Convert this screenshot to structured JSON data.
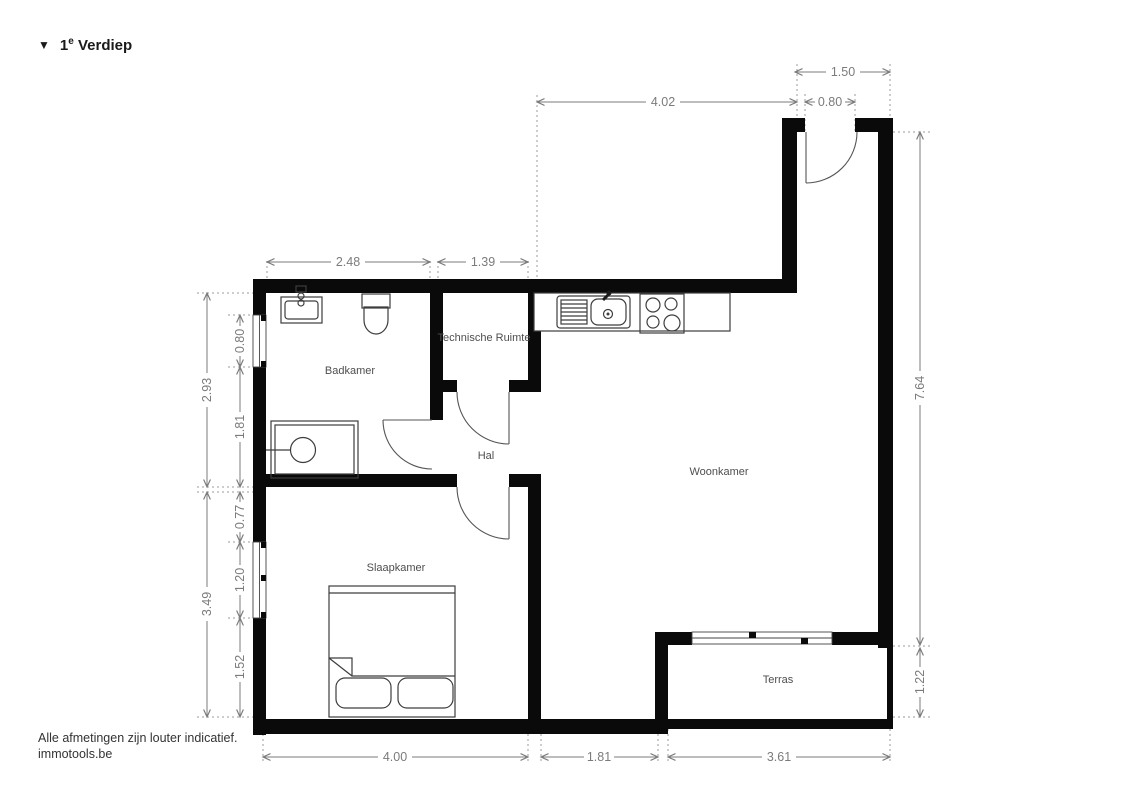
{
  "title": {
    "icon": "▼",
    "number": "1",
    "suffix": "e",
    "word": "Verdiep"
  },
  "footer": {
    "disclaimer": "Alle afmetingen zijn louter indicatief.",
    "site": "immotools.be"
  },
  "rooms": {
    "badkamer": "Badkamer",
    "technische_ruimte": "Technische Ruimte",
    "hal": "Hal",
    "woonkamer": "Woonkamer",
    "slaapkamer": "Slaapkamer",
    "terras": "Terras"
  },
  "dimensions": {
    "entry_recess_width": "1.50",
    "living_top_width": "4.02",
    "entry_door_width": "0.80",
    "badkamer_width": "2.48",
    "technische_ruimte_width": "1.39",
    "badkamer_height_total": "2.93",
    "badkamer_window": "0.80",
    "badkamer_lower": "1.81",
    "slaapkamer_height_total": "3.49",
    "slaapkamer_upper": "0.77",
    "slaapkamer_window": "1.20",
    "slaapkamer_lower": "1.52",
    "right_side_height": "7.64",
    "terras_height": "1.22",
    "slaapkamer_width": "4.00",
    "hal_bottom_width": "1.81",
    "terras_width": "3.61"
  },
  "colors": {
    "wall": "#0a0a0a",
    "dimension_text": "#7b7b7b",
    "room_label": "#4e4e4e",
    "fixture_outline": "#3d3d3d",
    "extension_line": "#9b9b9b"
  }
}
